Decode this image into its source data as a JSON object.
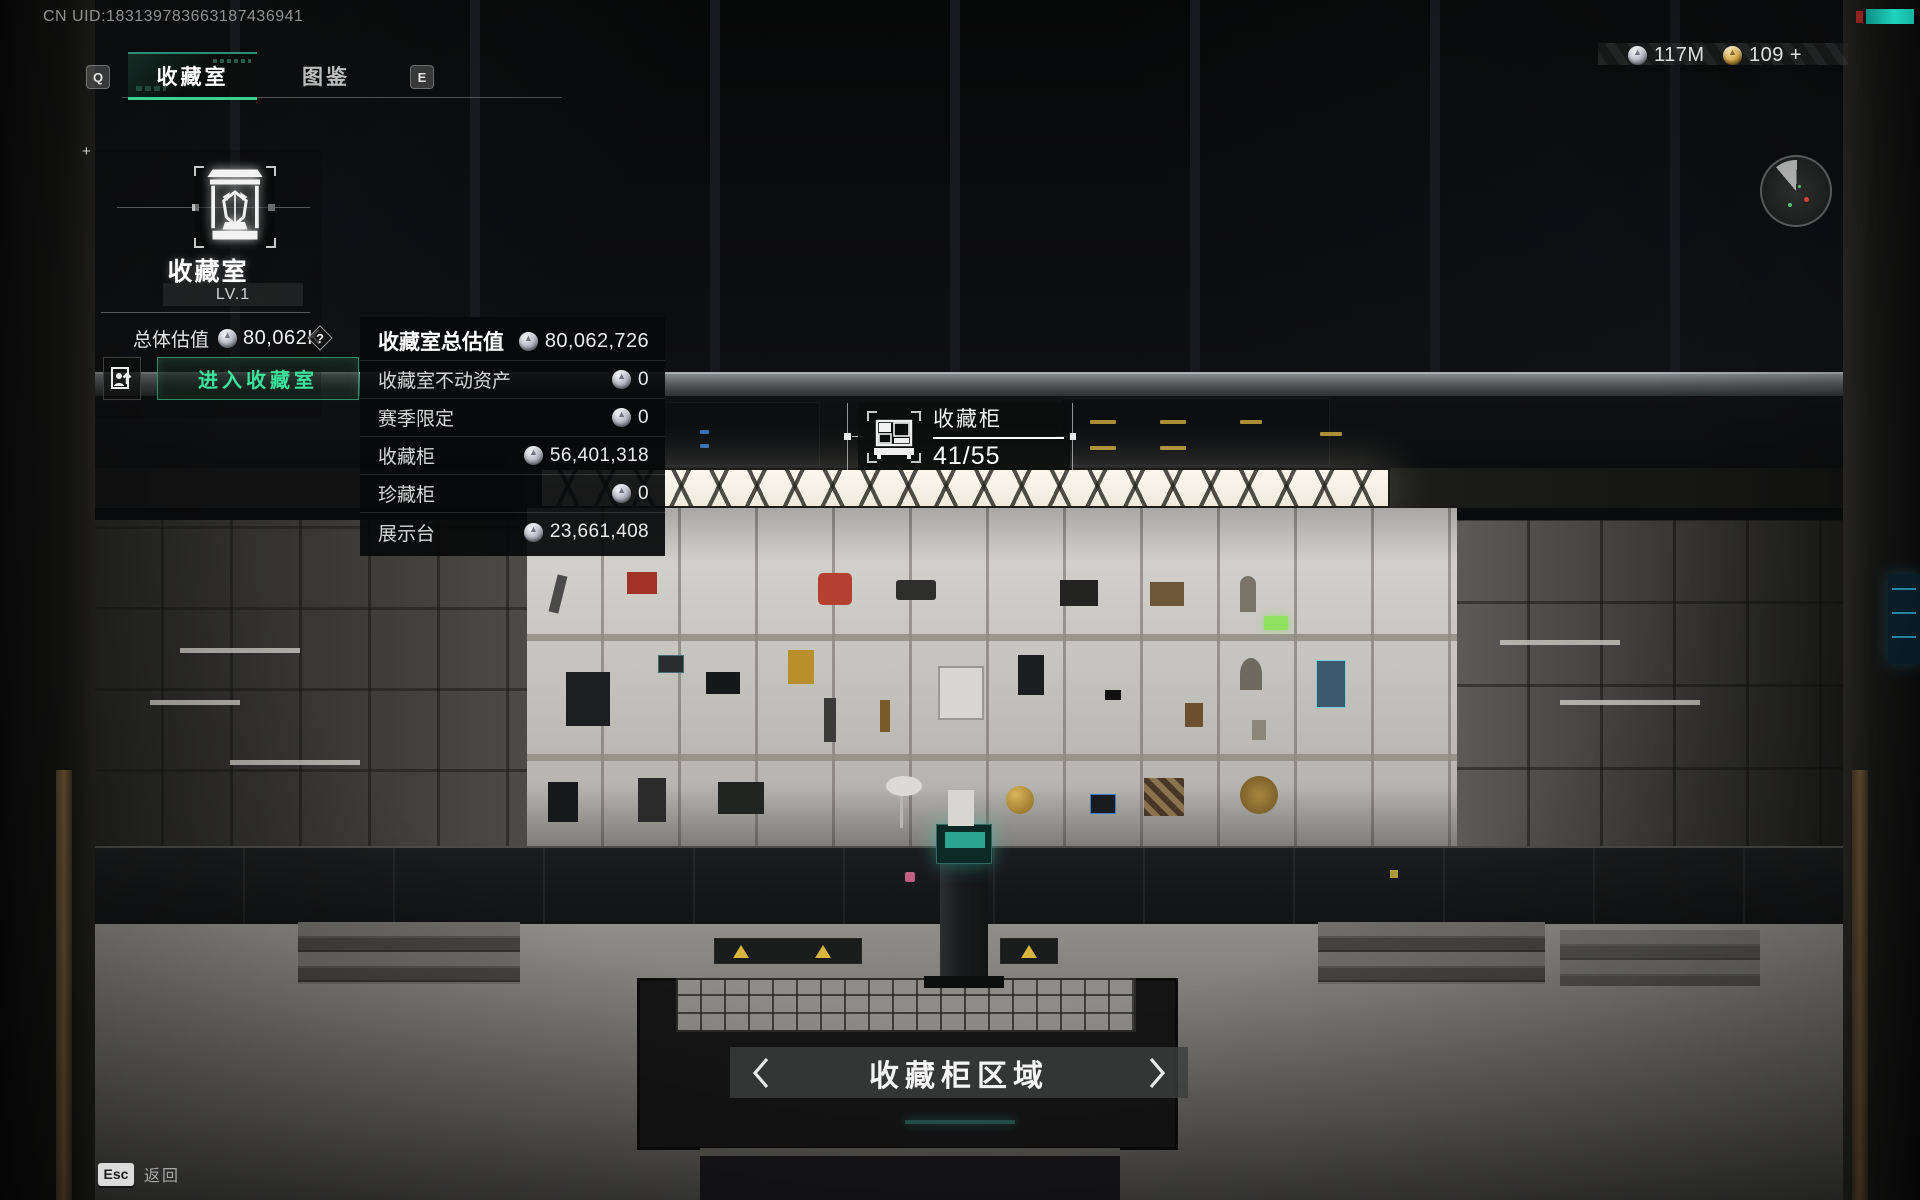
{
  "meta": {
    "uid": "CN UID:183139783663187436941"
  },
  "tabs": {
    "key_left": "Q",
    "key_right": "E",
    "items": [
      {
        "label": "收藏室",
        "active": true
      },
      {
        "label": "图鉴",
        "active": false
      }
    ]
  },
  "collection_panel": {
    "title": "收藏室",
    "level": "LV.1",
    "total_value_label": "总体估值",
    "total_value": "80,062K",
    "help": "?",
    "enter_button": "进入收藏室"
  },
  "value_breakdown": {
    "rows": [
      {
        "label": "收藏室总估值",
        "value": "80,062,726"
      },
      {
        "label": "收藏室不动资产",
        "value": "0"
      },
      {
        "label": "赛季限定",
        "value": "0"
      },
      {
        "label": "收藏柜",
        "value": "56,401,318"
      },
      {
        "label": "珍藏柜",
        "value": "0"
      },
      {
        "label": "展示台",
        "value": "23,661,408"
      }
    ]
  },
  "cabinet_marker": {
    "title": "收藏柜",
    "count": "41/55"
  },
  "currencies": [
    {
      "icon": "silver-coin",
      "amount": "117M"
    },
    {
      "icon": "gold-coin",
      "amount": "109 +"
    }
  ],
  "area_nav": {
    "label": "收藏柜区域"
  },
  "footer": {
    "key": "Esc",
    "label": "返回"
  },
  "colors": {
    "accent_green": "#38d390",
    "enter_text_green": "#3ce39a",
    "teal_screen": "#35c4ae",
    "corner_teal": "#1fd3c0",
    "skylight": "#fbf8ef"
  }
}
